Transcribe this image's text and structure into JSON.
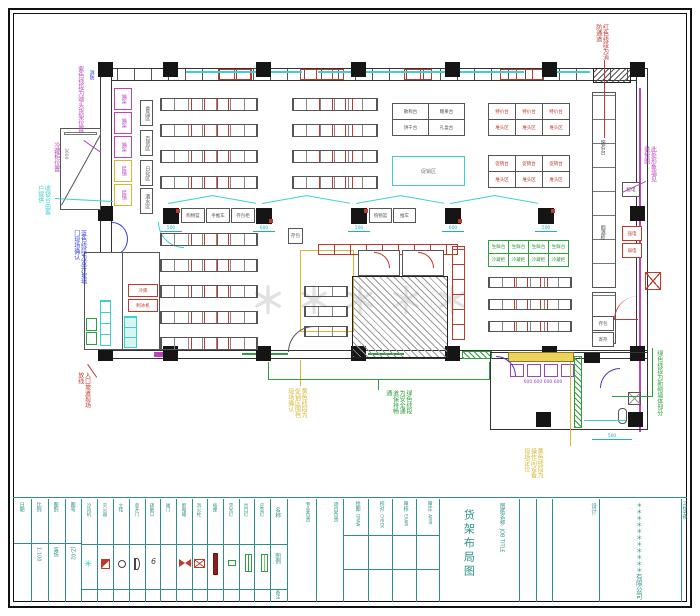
{
  "watermark": "＊＊＊＊＊",
  "ann": {
    "hydrant": "消防",
    "mag_tl": "紫色线段为端头货架位置",
    "mag_small": "冷藏柜位置",
    "cyan_left": "收银台由客户提供",
    "blue_door": "蓝色线段为双开玻璃门现场确认",
    "red_bl": "入口坡道现场放线",
    "yellow_c": "黄色线段为促销区围挡现场确认",
    "green_c": "绿色线段为安全通道保持畅通",
    "yellow_annex": "黄色线段为操作间设备现场定位",
    "green_annex": "绿色线段为新砌墙体部分",
    "red_top": "红色线段为消防通道",
    "mag_right": "此处形象墙见装修图"
  },
  "dims": {
    "d3600": "3600",
    "c1": "500",
    "c2": "600",
    "c3": "500",
    "c4": "600",
    "c5": "500",
    "annex": "500",
    "purple": "600 600 600 600"
  },
  "signs": [
    "食品区",
    "百货区",
    "日化区",
    "酒水区"
  ],
  "checkout": {
    "b1": "购物篮",
    "b2": "手推车",
    "b3": "存包柜",
    "b4": "购物篮",
    "b5": "推车",
    "b6": "存包"
  },
  "tables": {
    "c": [
      [
        "散称台",
        "糖果台"
      ],
      [
        "饼干台",
        "礼盒台"
      ]
    ],
    "d": [
      [
        "特价台",
        "特价台",
        "特价台"
      ],
      [
        "堆头区",
        "堆头区",
        "堆头区"
      ]
    ],
    "e": [
      [
        "促销台",
        "促销台",
        "促销台"
      ],
      [
        "堆头区",
        "堆头区",
        "堆头区"
      ]
    ],
    "g": [
      [
        "生鲜台",
        "生鲜台",
        "生鲜台",
        "生鲜台"
      ],
      [
        "冷藏柜",
        "冷藏柜",
        "冷藏柜",
        "冷藏柜"
      ]
    ],
    "promo": "促销区"
  },
  "left": {
    "mag": "端架",
    "yel": "促销",
    "red1": "冷库",
    "red2": "制冰机"
  },
  "right": {
    "counter1": "服务台",
    "counter2": "烟酒柜",
    "box1": "配电",
    "red1": "强电",
    "red2": "弱电",
    "low1": "存包",
    "low2": "寄存"
  },
  "tb": {
    "info": [
      {
        "h": "日期",
        "v": "　"
      },
      {
        "h": "比例",
        "v": "1:100"
      },
      {
        "h": "图别",
        "v": "装饰"
      },
      {
        "h": "图号",
        "v": "JZ-02"
      }
    ],
    "legend_headers": {
      "name": "名称",
      "symbol": "图例",
      "remark": "备注"
    },
    "legend": [
      {
        "name": "冷风机"
      },
      {
        "name": "灭火器"
      },
      {
        "name": "立柱"
      },
      {
        "name": "单开门"
      },
      {
        "name": "疏散口"
      },
      {
        "name": "阀门"
      },
      {
        "name": "配电箱"
      },
      {
        "name": "消火栓"
      },
      {
        "name": "插座"
      },
      {
        "name": "荧光灯"
      },
      {
        "name": "出口灯"
      },
      {
        "name": "应急灯"
      }
    ],
    "dept": [
      "专业负责",
      "项目负责"
    ],
    "cols": [
      {
        "h": "绘图:",
        "e": "DRAW"
      },
      {
        "h": "校对:",
        "e": "CHECK"
      },
      {
        "h": "审核:",
        "e": "EXAM"
      },
      {
        "h": "审定:",
        "e": "APPR"
      }
    ],
    "job_label": "图纸名称:",
    "job_en": "JOB TITLE",
    "job_title": "货架布局图",
    "design": "设计:",
    "company": "＊＊＊＊＊＊＊＊＊＊＊有限公司",
    "project": "工程名称:"
  }
}
